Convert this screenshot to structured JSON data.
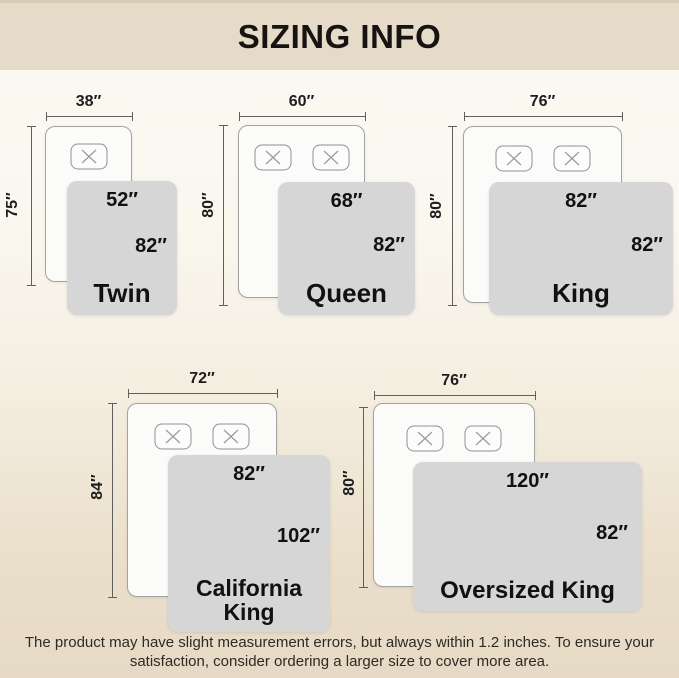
{
  "header": {
    "title": "SIZING INFO"
  },
  "footer": {
    "line1": "The product may have slight measurement errors, but always within 1.2 inches. To ensure your",
    "line2": "satisfaction, consider ordering a larger size to cover more area."
  },
  "colors": {
    "banner_bg": "#e6dbc9",
    "page_gradient_top": "#faf7ef",
    "page_gradient_bottom": "#e6dac5",
    "blanket_fill": "#d6d6d6",
    "bed_fill": "#fbfbfa",
    "bed_border": "#a3a3a3",
    "dimension_line": "#5f5f5f",
    "text": "#171310"
  },
  "diagrams": [
    {
      "name": "Twin",
      "bed_width": "38″",
      "bed_length": "75″",
      "blanket_width": "52″",
      "blanket_length": "82″",
      "pillows": 1
    },
    {
      "name": "Queen",
      "bed_width": "60″",
      "bed_length": "80″",
      "blanket_width": "68″",
      "blanket_length": "82″",
      "pillows": 2
    },
    {
      "name": "King",
      "bed_width": "76″",
      "bed_length": "80″",
      "blanket_width": "82″",
      "blanket_length": "82″",
      "pillows": 2
    },
    {
      "name": "California King",
      "bed_width": "72″",
      "bed_length": "84″",
      "blanket_width": "82″",
      "blanket_length": "102″",
      "pillows": 2
    },
    {
      "name": "Oversized King",
      "bed_width": "76″",
      "bed_length": "80″",
      "blanket_width": "120″",
      "blanket_length": "82″",
      "pillows": 2
    }
  ]
}
